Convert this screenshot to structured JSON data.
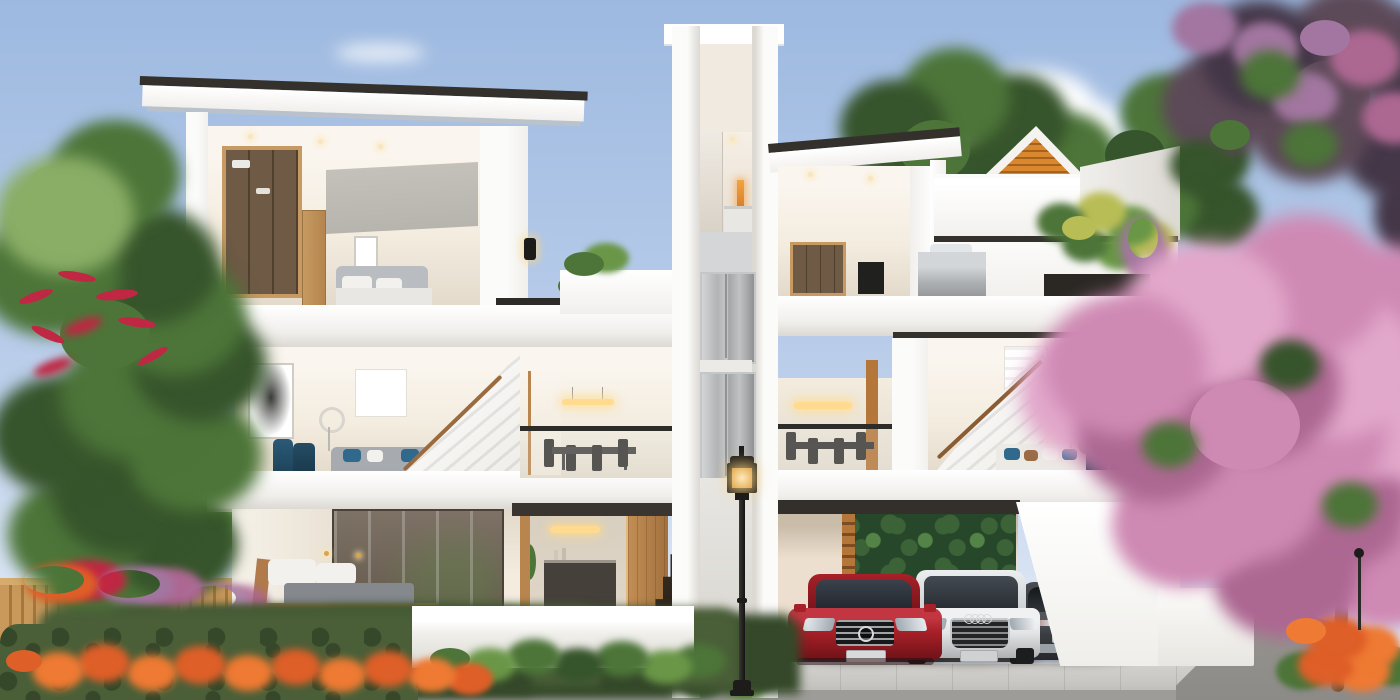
{
  "scene": {
    "kind": "photorealistic architectural exterior render",
    "subject": "modern three-storey twin villa shown in front cutaway elevation with landscaped street frontage",
    "sky": "clear blue daytime sky with scattered white clouds"
  },
  "building": {
    "floors": [
      "ground floor: bedroom, entry foyer with timber doors, marble steps, car porch",
      "second floor: living rooms, dining rooms, staircases, glass balustrades",
      "top floor: bedrooms with wardrobes, open terrace, roof terrace with pergola"
    ],
    "features": [
      "central elevator shaft with grey metal doors",
      "flat roofs with dark fascia trim",
      "timber slat pergola gable",
      "rooftop barbecue and planters with palms",
      "green feature wall in car porch",
      "white planter walls"
    ]
  },
  "vehicles": [
    {
      "name": "red-sedan",
      "view": "front",
      "color": "#a82028"
    },
    {
      "name": "white-estate",
      "view": "front",
      "color": "#e2e4e5"
    },
    {
      "name": "dark-grey-sedan",
      "view": "rear",
      "color": "#3b3e42"
    }
  ],
  "landscape": [
    "red-bottlebrush-tree",
    "timber-batten-fence",
    "clipped-hedge",
    "orange-flower-beds",
    "banana-foliage",
    "classic-street-lamp",
    "pink-blossom-tree",
    "purple-foliage-tree",
    "paved-sidewalk",
    "side-road"
  ],
  "colors": {
    "skyTop": "#9db9e0",
    "skyMid": "#bccfeb",
    "skyLow": "#dde7f5",
    "cloud": "#ffffff",
    "wallBright": "#fbfbf9",
    "wallWhite": "#f1efec",
    "wallShade": "#dcd9d3",
    "wallShadow": "#c6c3bc",
    "roofTrim": "#34312d",
    "interiorCeil": "#faf5ee",
    "interiorWarm": "#f3ecdf",
    "interiorShade": "#e2d9ca",
    "woodAccent": "#c69a62",
    "doorWood": "#b9854f",
    "wardrobeGlass": "#6e5a45",
    "wardrobeGlass2": "#50402e",
    "concrete": "#b7b4ae",
    "sofaGray": "#a7abb0",
    "teal": "#2b5a77",
    "pillowBlue": "#31698c",
    "pillowWhite": "#f2f1ee",
    "blanket": "#85898e",
    "bedWood": "#b07a4a",
    "railDark": "#2e2c29",
    "greenFeather": "#8aae66",
    "greenLight": "#6a9747",
    "greenMid": "#4d7539",
    "greenDark": "#37552c",
    "palmYellow": "#b9bd55",
    "redFlower": "#c02743",
    "orangeFlower": "#df5f28",
    "orangeBright": "#ee7a33",
    "pinkLight": "#e2a8cb",
    "pinkMid": "#cf8ab4",
    "pinkDeep": "#ad6892",
    "lilac": "#a276a0",
    "purpleFoliage": "#5d4a58",
    "purpleDark": "#443748",
    "fenceWood": "#c9995c",
    "fenceGap": "#a5773f",
    "hedge": "#4a5f38",
    "hedgeDark": "#35492a",
    "pavement": "#c9c7c3",
    "pavementDark": "#9e9c98",
    "road": "#8d8b88",
    "garageWall": "#ecdfcf",
    "garageFloor": "#53504b",
    "greenWallDark": "#27472a",
    "greenWallMid": "#3c6337",
    "greenWallLight": "#538347",
    "marble": "#342b22",
    "lampBlack": "#1d1c1a",
    "lampGlow": "#ffda8f",
    "pergola": "#d9882f",
    "pergolaDark": "#a6611b",
    "artInk": "#3a3a38",
    "chrome": "#d7dadc",
    "carRed": "#a82028",
    "carRedDark": "#6e1218",
    "carWhite": "#e2e4e5",
    "carWhiteShade": "#aeb1b4",
    "carDark": "#3b3e42",
    "carDarkDeep": "#26282c",
    "glassDark": "#23262b"
  }
}
